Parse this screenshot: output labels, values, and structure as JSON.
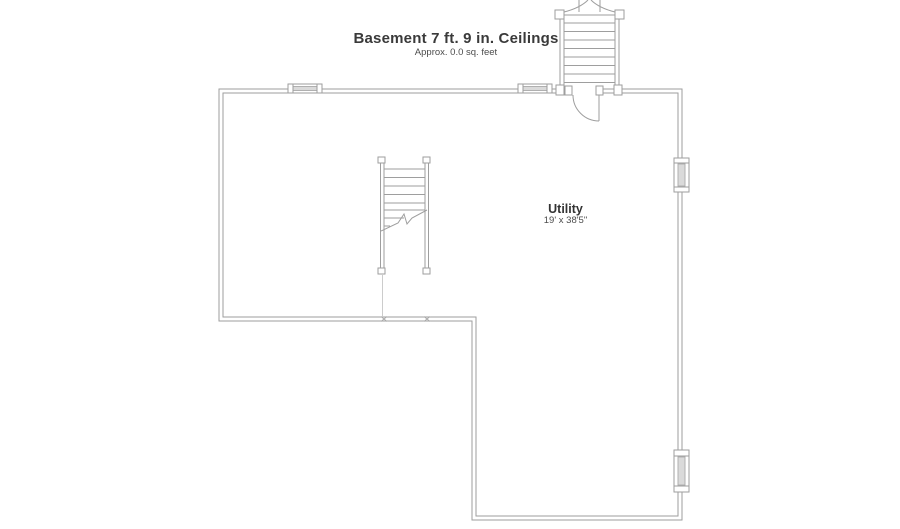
{
  "header": {
    "title": "Basement 7 ft. 9 in. Ceilings",
    "subtitle": "Approx. 0.0 sq. feet"
  },
  "rooms": [
    {
      "name": "Utility",
      "dimensions": "19' x 38'5\""
    }
  ],
  "floorplan": {
    "features": [
      "exterior-bulkhead-stairs",
      "basement-entry-door",
      "interior-staircase-with-break-line",
      "top-wall-window-left",
      "top-wall-window-right",
      "right-wall-window-upper",
      "right-wall-window-lower"
    ],
    "colors": {
      "wall_line": "#9e9e9e",
      "window_glass": "#dadada",
      "faint_line": "#cccccc",
      "title_text": "#3a3a3a"
    }
  }
}
